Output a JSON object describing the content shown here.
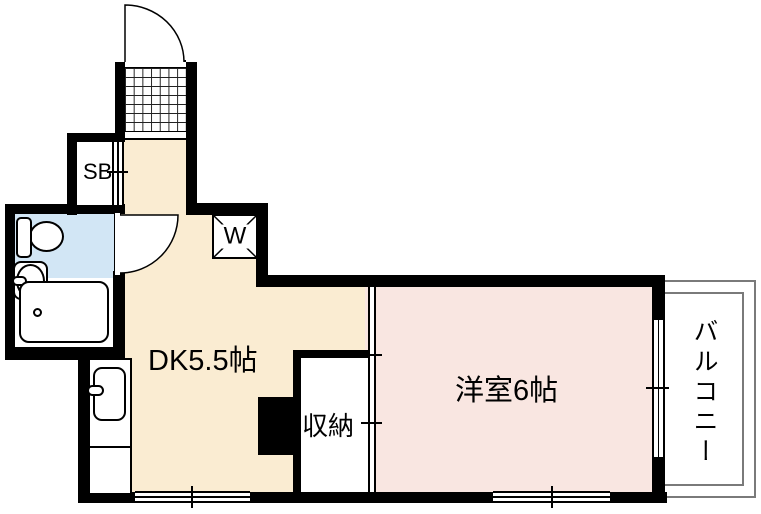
{
  "floorplan": {
    "type": "apartment-floor-plan",
    "labels": {
      "dining_kitchen": "DK5.5帖",
      "western_room": "洋室6帖",
      "storage": "収納",
      "shoe_box": "SB",
      "washing_machine": "W",
      "balcony": "バルコニー"
    },
    "colors": {
      "dk-floor": "#faecd2",
      "western-floor": "#f9e6e1",
      "bathroom-floor": "#d2e6f5",
      "wall": "#000000",
      "balcony-line": "#7a7a7a"
    }
  }
}
